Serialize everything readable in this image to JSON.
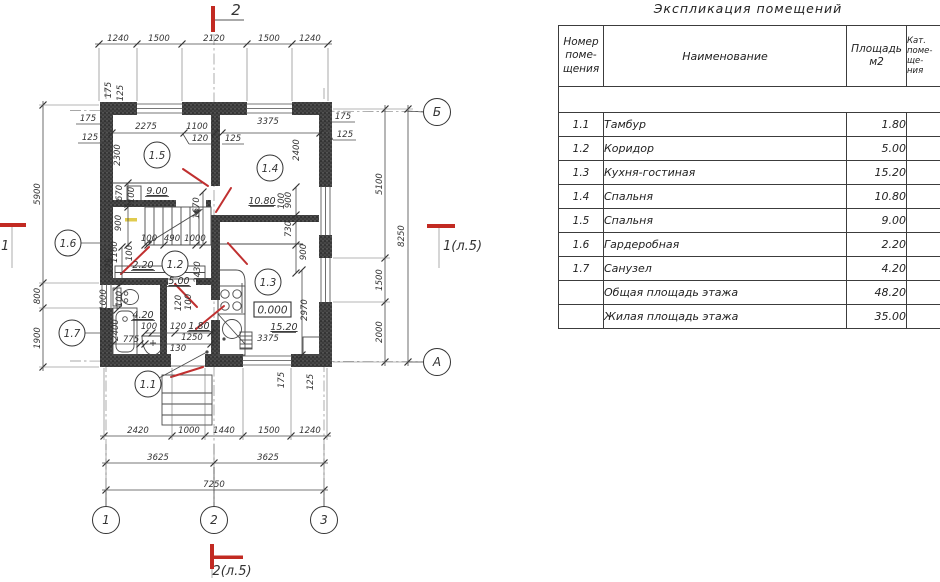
{
  "table": {
    "title": "Экспликация помещений",
    "headers": {
      "number": "Номер\nпоме-\nщения",
      "name": "Наименование",
      "area": "Площадь\nм2",
      "category": "Кат.\nпоме-\nще-\nния"
    },
    "rows": [
      {
        "num": "1.1",
        "name": "Тамбур",
        "area": "1.80",
        "cat": ""
      },
      {
        "num": "1.2",
        "name": "Коридор",
        "area": "5.00",
        "cat": ""
      },
      {
        "num": "1.3",
        "name": "Кухня-гостиная",
        "area": "15.20",
        "cat": ""
      },
      {
        "num": "1.4",
        "name": "Спальня",
        "area": "10.80",
        "cat": ""
      },
      {
        "num": "1.5",
        "name": "Спальня",
        "area": "9.00",
        "cat": ""
      },
      {
        "num": "1.6",
        "name": "Гардеробная",
        "area": "2.20",
        "cat": ""
      },
      {
        "num": "1.7",
        "name": "Санузел",
        "area": "4.20",
        "cat": ""
      },
      {
        "num": "",
        "name": "Общая площадь этажа",
        "area": "48.20",
        "cat": ""
      },
      {
        "num": "",
        "name": "Жилая площадь этажа",
        "area": "35.00",
        "cat": ""
      }
    ]
  },
  "plan": {
    "section_markers": {
      "top": "2",
      "bottom": "2(л.5)",
      "left": "1",
      "right": "1(л.5)"
    },
    "elevation_mark": "0.000",
    "axis_circles": [
      {
        "label": "1",
        "x": 106,
        "y": 520
      },
      {
        "label": "2",
        "x": 214,
        "y": 520
      },
      {
        "label": "3",
        "x": 324,
        "y": 520
      },
      {
        "label": "Б",
        "x": 437,
        "y": 112
      },
      {
        "label": "А",
        "x": 437,
        "y": 362
      }
    ],
    "room_circles": [
      {
        "label": "1.5",
        "x": 157,
        "y": 155
      },
      {
        "label": "1.4",
        "x": 270,
        "y": 168
      },
      {
        "label": "1.2",
        "x": 175,
        "y": 264
      },
      {
        "label": "1.6",
        "x": 68,
        "y": 243
      },
      {
        "label": "1.7",
        "x": 72,
        "y": 333
      },
      {
        "label": "1.3",
        "x": 268,
        "y": 282
      },
      {
        "label": "1.1",
        "x": 148,
        "y": 384
      }
    ],
    "labels": [
      {
        "t": "1240",
        "x": 118,
        "y": 41
      },
      {
        "t": "1500",
        "x": 159,
        "y": 41
      },
      {
        "t": "2120",
        "x": 214,
        "y": 41
      },
      {
        "t": "1500",
        "x": 269,
        "y": 41
      },
      {
        "t": "1240",
        "x": 310,
        "y": 41
      },
      {
        "t": "175",
        "x": 111,
        "y": 90,
        "v": 1
      },
      {
        "t": "125",
        "x": 123,
        "y": 93,
        "v": 1
      },
      {
        "t": "175",
        "x": 88,
        "y": 121
      },
      {
        "t": "125",
        "x": 90,
        "y": 140
      },
      {
        "t": "2275",
        "x": 146,
        "y": 129
      },
      {
        "t": "1100",
        "x": 197,
        "y": 129
      },
      {
        "t": "120",
        "x": 200,
        "y": 141
      },
      {
        "t": "125",
        "x": 233,
        "y": 141
      },
      {
        "t": "3375",
        "x": 268,
        "y": 124
      },
      {
        "t": "175",
        "x": 343,
        "y": 119
      },
      {
        "t": "125",
        "x": 345,
        "y": 137
      },
      {
        "t": "2300",
        "x": 120,
        "y": 155,
        "v": 1
      },
      {
        "t": "2400",
        "x": 299,
        "y": 150,
        "v": 1
      },
      {
        "t": "9.00",
        "x": 157,
        "y": 194,
        "u": 1
      },
      {
        "t": "670",
        "x": 122,
        "y": 193,
        "v": 1
      },
      {
        "t": "100",
        "x": 134,
        "y": 195,
        "v": 1
      },
      {
        "t": "900",
        "x": 121,
        "y": 223,
        "v": 1
      },
      {
        "t": "1670",
        "x": 199,
        "y": 208,
        "v": 1
      },
      {
        "t": "10.80",
        "x": 262,
        "y": 204,
        "u": 1
      },
      {
        "t": "100",
        "x": 284,
        "y": 201,
        "v": 1
      },
      {
        "t": "900",
        "x": 291,
        "y": 200,
        "v": 1
      },
      {
        "t": "730",
        "x": 291,
        "y": 229,
        "v": 1
      },
      {
        "t": "100",
        "x": 149,
        "y": 241
      },
      {
        "t": "490",
        "x": 172,
        "y": 241
      },
      {
        "t": "1000",
        "x": 195,
        "y": 241
      },
      {
        "t": "1160",
        "x": 117,
        "y": 252,
        "v": 1
      },
      {
        "t": "100",
        "x": 132,
        "y": 253,
        "v": 1
      },
      {
        "t": "175",
        "x": 112,
        "y": 266,
        "v": 1
      },
      {
        "t": "2.20",
        "x": 143,
        "y": 268,
        "u": 1
      },
      {
        "t": "5.00",
        "x": 179,
        "y": 284,
        "u": 1
      },
      {
        "t": "2430",
        "x": 200,
        "y": 272,
        "v": 1
      },
      {
        "t": "900",
        "x": 306,
        "y": 252,
        "v": 1
      },
      {
        "t": "2970",
        "x": 307,
        "y": 310,
        "v": 1
      },
      {
        "t": "1000",
        "x": 106,
        "y": 300,
        "v": 1
      },
      {
        "t": "100",
        "x": 122,
        "y": 299,
        "v": 1
      },
      {
        "t": "120",
        "x": 181,
        "y": 303,
        "v": 1
      },
      {
        "t": "100",
        "x": 191,
        "y": 302,
        "v": 1
      },
      {
        "t": "4.20",
        "x": 143,
        "y": 318,
        "u": 1
      },
      {
        "t": "2400",
        "x": 118,
        "y": 330,
        "v": 1
      },
      {
        "t": "100",
        "x": 149,
        "y": 329
      },
      {
        "t": "120",
        "x": 178,
        "y": 329
      },
      {
        "t": "1.80",
        "x": 199,
        "y": 329,
        "u": 1
      },
      {
        "t": "775",
        "x": 131,
        "y": 342
      },
      {
        "t": "1250",
        "x": 192,
        "y": 340
      },
      {
        "t": "130",
        "x": 178,
        "y": 351
      },
      {
        "t": "15.20",
        "x": 284,
        "y": 330,
        "u": 1
      },
      {
        "t": "3375",
        "x": 268,
        "y": 341
      },
      {
        "t": "175",
        "x": 284,
        "y": 380,
        "v": 1
      },
      {
        "t": "125",
        "x": 313,
        "y": 382,
        "v": 1
      },
      {
        "t": "2420",
        "x": 138,
        "y": 433
      },
      {
        "t": "1000",
        "x": 189,
        "y": 433
      },
      {
        "t": "1440",
        "x": 224,
        "y": 433
      },
      {
        "t": "1500",
        "x": 269,
        "y": 433
      },
      {
        "t": "1240",
        "x": 310,
        "y": 433
      },
      {
        "t": "3625",
        "x": 158,
        "y": 460
      },
      {
        "t": "3625",
        "x": 268,
        "y": 460
      },
      {
        "t": "7250",
        "x": 214,
        "y": 487
      },
      {
        "t": "5900",
        "x": 40,
        "y": 194,
        "v": 1
      },
      {
        "t": "800",
        "x": 40,
        "y": 296,
        "v": 1
      },
      {
        "t": "1900",
        "x": 40,
        "y": 338,
        "v": 1
      },
      {
        "t": "5100",
        "x": 382,
        "y": 184,
        "v": 1
      },
      {
        "t": "1500",
        "x": 382,
        "y": 280,
        "v": 1
      },
      {
        "t": "2000",
        "x": 382,
        "y": 332,
        "v": 1
      },
      {
        "t": "8250",
        "x": 404,
        "y": 236,
        "v": 1
      }
    ]
  },
  "colors": {
    "section_red": "#c22a22",
    "door_red": "#c03030",
    "wall_dark": "#3f3f3f",
    "line": "#4a4a4a",
    "stair_highlight": "#e0cb4d"
  }
}
